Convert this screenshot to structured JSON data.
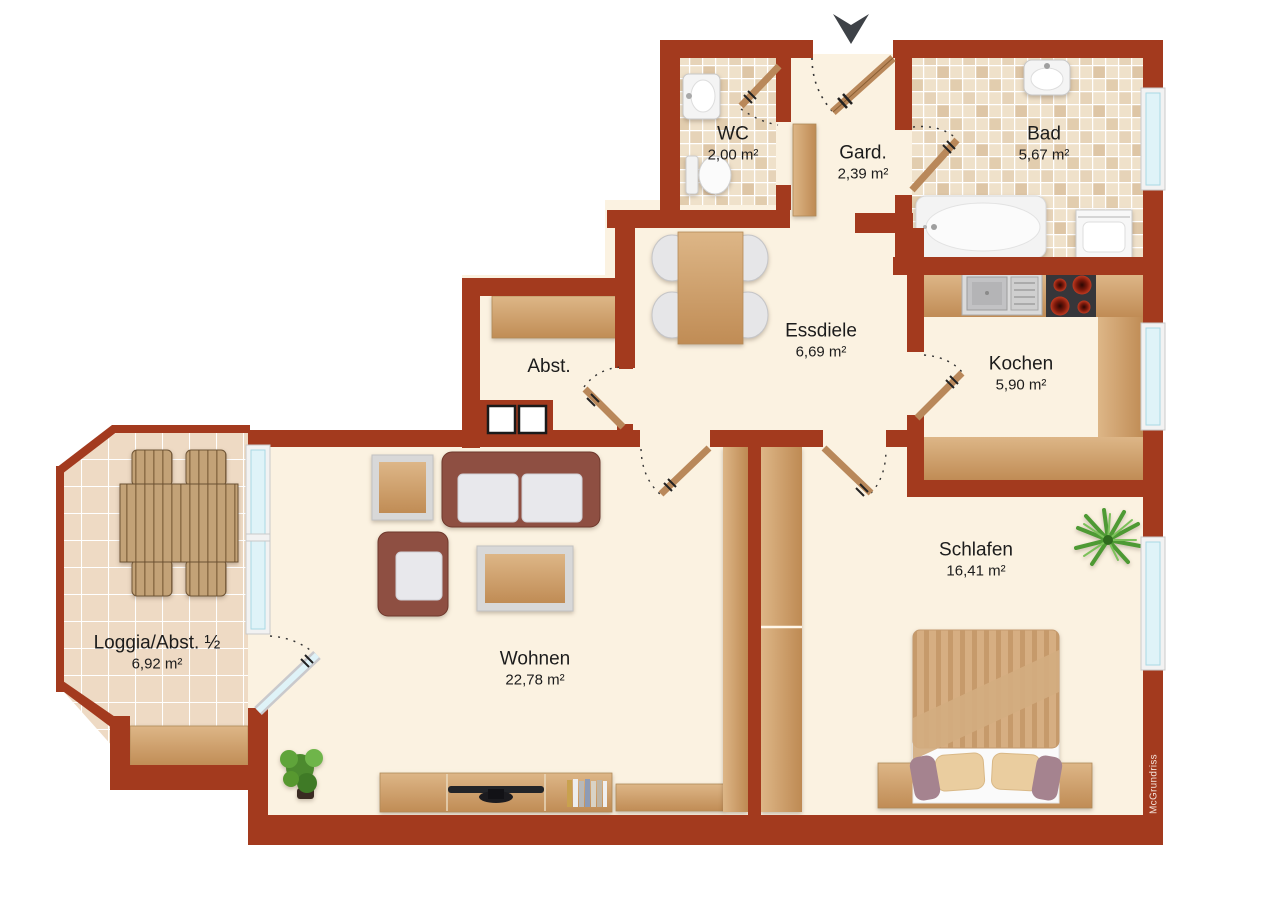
{
  "title": "Apartment floor plan",
  "brand": "McGrundriss",
  "rooms": [
    {
      "id": "wc",
      "name": "WC",
      "area": "2,00 m²"
    },
    {
      "id": "gard",
      "name": "Gard.",
      "area": "2,39 m²"
    },
    {
      "id": "bad",
      "name": "Bad",
      "area": "5,67 m²"
    },
    {
      "id": "essdiele",
      "name": "Essdiele",
      "area": "6,69 m²"
    },
    {
      "id": "abst",
      "name": "Abst.",
      "area": ""
    },
    {
      "id": "kochen",
      "name": "Kochen",
      "area": "5,90 m²"
    },
    {
      "id": "loggia",
      "name": "Loggia/Abst. ½",
      "area": "6,92 m²"
    },
    {
      "id": "wohnen",
      "name": "Wohnen",
      "area": "22,78 m²"
    },
    {
      "id": "schlafen",
      "name": "Schlafen",
      "area": "16,41 m²"
    }
  ],
  "icons": [
    "entrance-arrow-icon",
    "door-icon",
    "window-icon",
    "bathtub-icon",
    "toilet-icon",
    "sink-icon",
    "washing-machine-icon",
    "stove-icon",
    "kitchen-sink-icon",
    "sofa-icon",
    "armchair-icon",
    "coffee-table-icon",
    "dining-table-icon",
    "chair-icon",
    "bed-icon",
    "wardrobe-icon",
    "shelf-icon",
    "tv-icon",
    "books-icon",
    "plant-icon",
    "garden-table-icon",
    "bench-icon",
    "shaft-icon"
  ],
  "colors": {
    "wall": "#A33A1E",
    "floor": "#FBF2E1",
    "tile_light": "#EFE1CA",
    "tile_dark": "#DEC6A6",
    "loggia_tile": "#EEDAC4",
    "wood": "#CBA06B",
    "door_leaf": "#B9885A",
    "glass": "#DFF3F8",
    "sofa": "#8E4F42",
    "arrow": "#3E4247"
  }
}
